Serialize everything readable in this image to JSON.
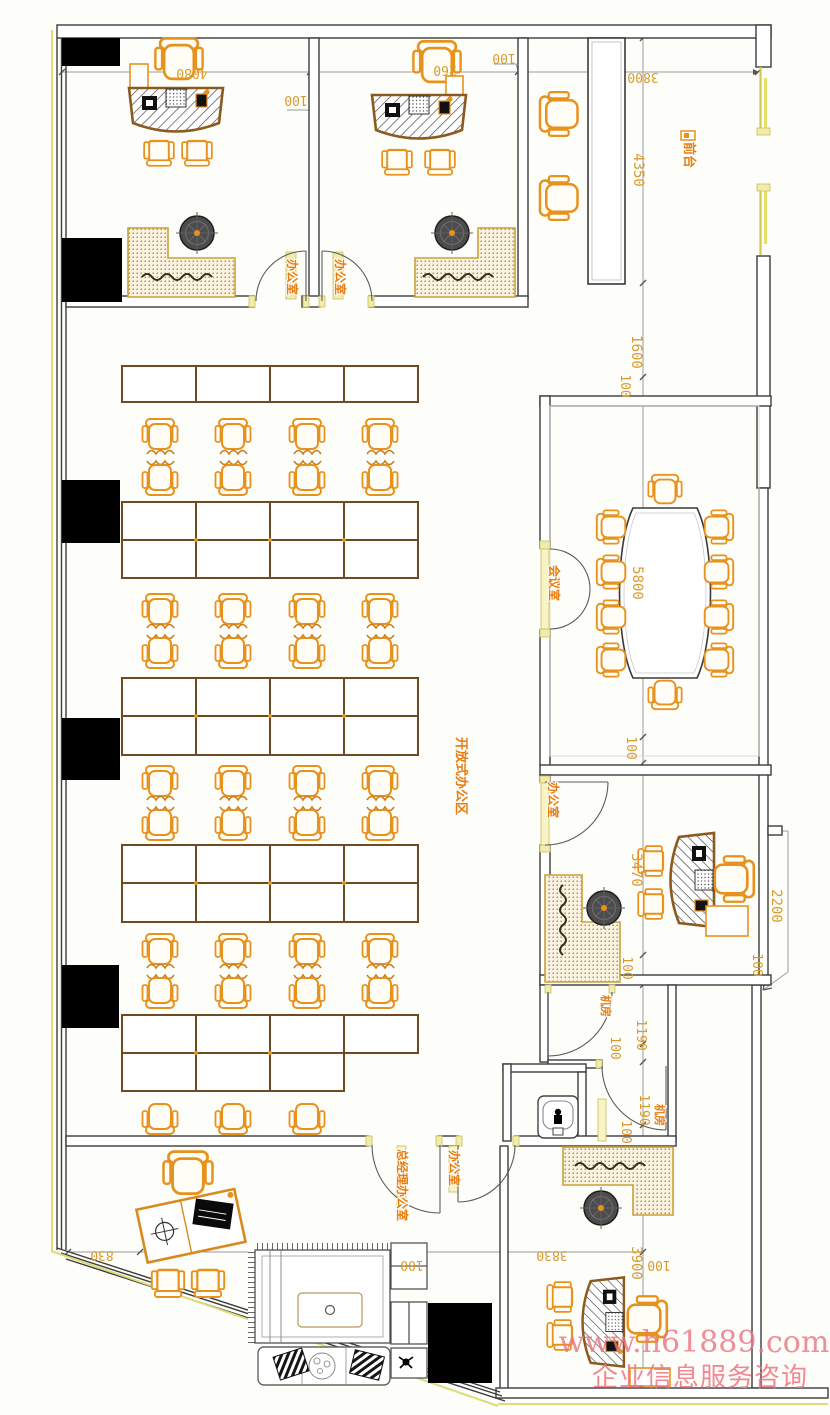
{
  "plan": {
    "watermark": {
      "line1": "www.h61889.com",
      "line2": "企业信息服务咨询"
    },
    "rooms": {
      "office_top_left": "办公室",
      "office_top_mid": "办公室",
      "reception": "前台",
      "meeting_room": "会议室",
      "open_office": "开放式办公区",
      "office_mid_right": "办公室",
      "server_room_a": "机房",
      "server_room_b": "机房",
      "gm_office": "总经理办公室",
      "office_bottom_right": "办公室"
    },
    "dimensions": {
      "d4080": "4080",
      "d100_divider": "100",
      "d260": "260",
      "d100_office2": "100",
      "d3800": "3800",
      "d4350": "4350",
      "d1600": "1600",
      "d100_meeting_top": "100",
      "d5800": "5800",
      "d100_meeting_bottom": "100",
      "d3470": "3470",
      "d100_office_mid": "100",
      "d2200": "2200",
      "d100_right": "100",
      "d1190_a": "1190",
      "d100_server_a": "100",
      "d1190_b": "1190",
      "d100_server_b": "100",
      "d3830": "3830",
      "d3900": "3900",
      "d100_bottom_right": "100",
      "d830": "830",
      "d100_lounge": "100"
    },
    "colors": {
      "furniture": "#e8921e",
      "desk_outline": "#8a5a1e",
      "dimension_text": "#d99b2e",
      "room_label": "#e87d12",
      "wall": "#3c3c3c",
      "window": "#cfcb52",
      "column": "#000000",
      "watermark": "#ee7e8c"
    }
  }
}
